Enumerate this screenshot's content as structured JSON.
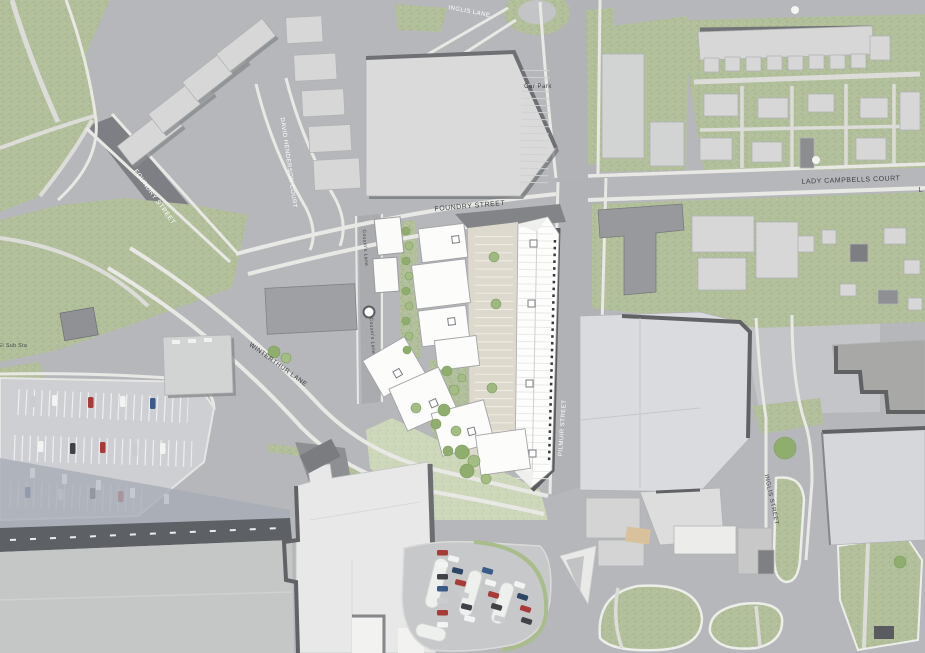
{
  "map": {
    "labels": {
      "inglis_lane": "INGLIS LANE",
      "car_park": "Car Park",
      "david_henderson_court": "DAVID HENDERSON COURT",
      "foundry_street_west": "FOUNDRY STREET",
      "foundry_street": "FOUNDRY STREET",
      "lady_campbells_court": "LADY CAMPBELLS COURT",
      "lady_campbells_truncated": "L",
      "el_sub_sta": "El Sub Sta",
      "cousins_lane_upper": "Cousin's Lane",
      "cousins_lane_lower": "Cousin's Lane",
      "winterthur_lane": "WINTERTHUR LANE",
      "pilmuir_street": "PILMUIR STREET",
      "inglis_street": "INGLIS STREET"
    },
    "palette": {
      "road": "#b6b7bb",
      "road_dark": "#7d7f84",
      "pavement": "#e8e8e5",
      "grass": "#b1bf9b",
      "grass_light": "#cdd7ba",
      "tree": "#8fae6e",
      "building_existing": "#d6d7d6",
      "building_dark": "#97999c",
      "development_white": "#fdfdfc",
      "courtyard_paving": "#ded9cd",
      "shadow": "#6e7073",
      "shade_blue": "#a8adb6",
      "car_red": "#a83a38",
      "car_blue": "#3a5a88",
      "car_dark": "#3f4246",
      "car_white": "#f2f3f2",
      "car_silver": "#c9cdd0"
    }
  }
}
